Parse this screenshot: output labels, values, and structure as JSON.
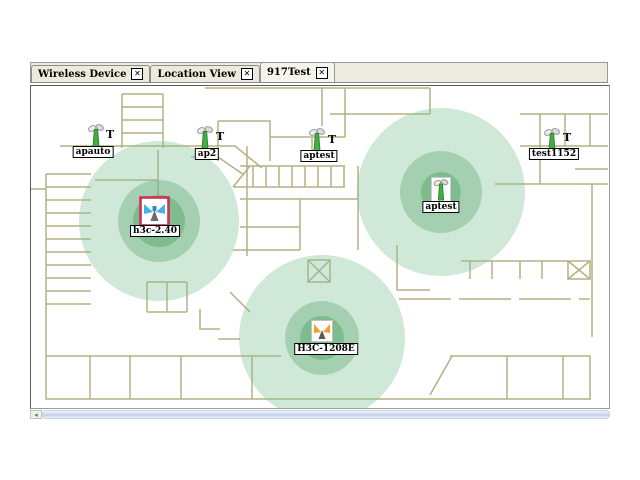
{
  "tabs": [
    {
      "label": "Wireless Device",
      "close": "✕",
      "active": false
    },
    {
      "label": "Location View",
      "close": "✕",
      "active": false
    },
    {
      "label": "917Test",
      "close": "✕",
      "active": true
    }
  ],
  "map": {
    "wall_color": "#b5b083",
    "coverage_colors": {
      "outer": "rgba(130,195,150,0.38)",
      "middle": "rgba(110,180,130,0.45)",
      "inner": "rgba(80,165,100,0.45)"
    },
    "aps": [
      {
        "name": "apauto",
        "icon": "antenna-green",
        "mark": "T",
        "x": 57,
        "y": 36,
        "mark_x": 75,
        "mark_y": 44,
        "label_x": 62,
        "label_y": 60,
        "coverage": null
      },
      {
        "name": "ap2",
        "icon": "antenna-green",
        "mark": "T",
        "x": 166,
        "y": 38,
        "mark_x": 185,
        "mark_y": 46,
        "label_x": 176,
        "label_y": 62,
        "coverage": null
      },
      {
        "name": "aptest",
        "icon": "antenna-green",
        "mark": "T",
        "x": 278,
        "y": 40,
        "mark_x": 297,
        "mark_y": 49,
        "label_x": 288,
        "label_y": 64,
        "coverage": null
      },
      {
        "name": "test1152",
        "icon": "antenna-green",
        "mark": "T",
        "x": 513,
        "y": 40,
        "mark_x": 532,
        "mark_y": 47,
        "label_x": 523,
        "label_y": 62,
        "coverage": null
      },
      {
        "name": "h3c-2.40",
        "icon": "antenna-selected",
        "mark": null,
        "x": 108,
        "y": 110,
        "label_x": 124,
        "label_y": 139,
        "coverage": {
          "cx": 128,
          "cy": 135,
          "r": [
            80,
            41,
            26
          ]
        }
      },
      {
        "name": "aptest",
        "icon": "antenna-green-boxed",
        "mark": null,
        "x": 400,
        "y": 91,
        "label_x": 410,
        "label_y": 115,
        "coverage": {
          "cx": 410,
          "cy": 106,
          "r": [
            84,
            41,
            20
          ]
        }
      },
      {
        "name": "H3C-1208E",
        "icon": "antenna-orange-boxed",
        "mark": null,
        "x": 280,
        "y": 234,
        "label_x": 295,
        "label_y": 257,
        "coverage": {
          "cx": 291,
          "cy": 252,
          "r": [
            83,
            37,
            22
          ]
        }
      }
    ]
  },
  "scrollbar": {
    "left_arrow": "◂"
  }
}
